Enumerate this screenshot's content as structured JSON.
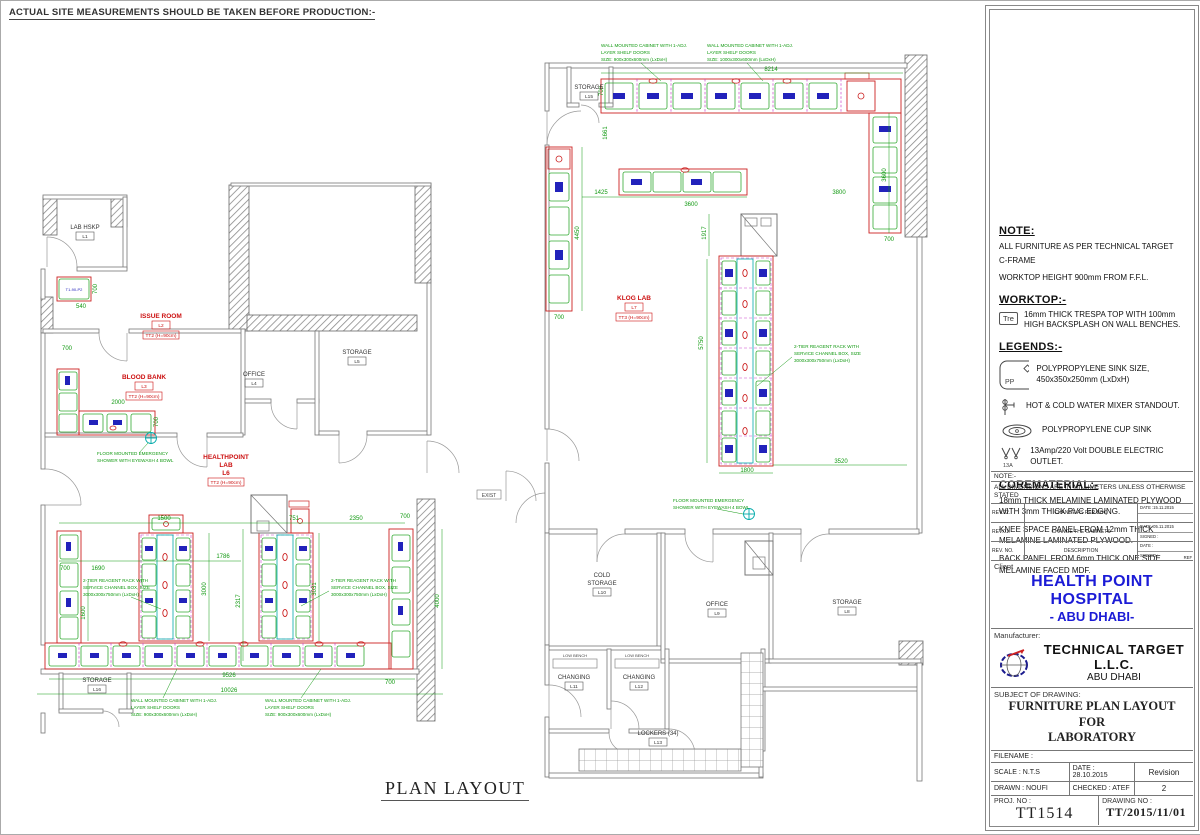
{
  "sheet": {
    "top_note": "ACTUAL SITE MEASUREMENTS SHOULD BE TAKEN BEFORE PRODUCTION:-",
    "plan_title": "PLAN LAYOUT",
    "exist_label": "EXIST"
  },
  "colors": {
    "client_blue": "#1b1bd6",
    "dim_green": "#119911",
    "cabinet_red": "#cc2222",
    "label_blue": "#2222bb",
    "channel_cyan": "#00aaaa"
  },
  "notes": {
    "reagent": [
      "2-TIER REAGENT RACK WITH",
      "SERVICE CHANNEL BOX, SIZE",
      "3000x300x750mm (LxDxH)"
    ],
    "wall_cab_900": [
      "WALL MOUNTED CABINET WITH 1-ADJ.",
      "LAYER SHELF DOORS",
      "SIZE: 900x300x600mm (LxDxH)"
    ],
    "wall_cab_1000": [
      "WALL MOUNTED CABINET WITH 1-ADJ.",
      "LAYER SHELF DOORS",
      "SIZE: 1000x300x600mm (LxDxH)"
    ],
    "shower": [
      "FLOOR MOUNTED EMERGENCY",
      "SHOWER WITH EYEWASH 4 BOWL"
    ],
    "low_bench": "LOW BENCH",
    "cabinet_code": "T1-90-P2"
  },
  "left_plan": {
    "rooms": [
      {
        "name": "LAB HSKP",
        "code": "L1"
      },
      {
        "name": "ISSUE ROOM",
        "code": "L2",
        "type": "TT2 (H=90cm)"
      },
      {
        "name": "BLOOD BANK",
        "code": "L3",
        "type": "TT2 (H=90cm)"
      },
      {
        "name": "OFFICE",
        "code": "L4"
      },
      {
        "name": "STORAGE",
        "code": "L5"
      },
      {
        "name": "HEALTHPOINT",
        "name2": "LAB",
        "code": "L6",
        "type": "TT2 (H=90cm)"
      },
      {
        "name": "STORAGE",
        "code": "L16"
      }
    ],
    "dims": [
      "540",
      "700",
      "700",
      "2000",
      "700",
      "1500",
      "751",
      "2350",
      "700",
      "1786",
      "1690",
      "700",
      "3000",
      "2317",
      "3031",
      "1600",
      "4000",
      "9526",
      "10026",
      "700"
    ]
  },
  "right_plan": {
    "rooms": [
      {
        "name": "STORAGE",
        "code": "L15"
      },
      {
        "name": "KLOG LAB",
        "code": "L7",
        "type": "TT3 (H=90cm)"
      },
      {
        "name": "COLD",
        "name2": "STORAGE",
        "code": "L10"
      },
      {
        "name": "OFFICE",
        "code": "L9"
      },
      {
        "name": "STORAGE",
        "code": "L8"
      },
      {
        "name": "CHANGING",
        "code": "L11"
      },
      {
        "name": "CHANGING",
        "code": "L12"
      },
      {
        "name": "LOCKERS (34)",
        "code": "L13"
      }
    ],
    "dims": [
      "8214",
      "700",
      "1661",
      "1425",
      "3600",
      "3800",
      "4450",
      "700",
      "1917",
      "5750",
      "3600",
      "700",
      "1800",
      "3520"
    ]
  },
  "panel": {
    "note": {
      "title": "NOTE:",
      "lines": [
        "ALL FURNITURE AS PER TECHNICAL TARGET",
        "C-FRAME",
        "WORKTOP HEIGHT 900mm FROM F.F.L."
      ]
    },
    "worktop": {
      "title": "WORKTOP:-",
      "icon_label": "Tre",
      "text": "16mm THICK TRESPA TOP WITH 100mm HIGH BACKSPLASH ON WALL BENCHES."
    },
    "legends": {
      "title": "LEGENDS:-",
      "sink_icon_label": "PP",
      "outlet_icon_label": "13A",
      "items": [
        "POLYPROPYLENE SINK SIZE, 450x350x250mm (LxDxH)",
        "HOT & COLD WATER MIXER STANDOUT.",
        "POLYPROPYLENE  CUP SINK",
        "13Amp/220 Volt DOUBLE ELECTRIC OUTLET."
      ]
    },
    "corematerial": {
      "title": "COREMATERIAL:-",
      "paras": [
        "18mm THICK MELAMINE LAMINATED PLYWOOD WITH 3mm THICK PVC EDGING.",
        "KNEE SPACE PANEL FROM 12mm THICK MELAMINE LAMINATED PLYWOOD.",
        "BACK PANEL FROM 6mm THICK ONE SIDE MELAMINE FACED MDF."
      ]
    },
    "note2": {
      "label": "NOTE:-",
      "text": "ALL DIMENSIONS ARE IN MILLIMETERS UNLESS OTHERWISE STATED"
    },
    "revisions": {
      "rows": [
        {
          "no": "REV.02.",
          "desc": "CHANGE AS PER BOQ",
          "date": "DATE :15.11.2015",
          "signed": ""
        },
        {
          "no": "REV.01.",
          "desc": "CHANGE THE CABINETS",
          "date": "DATE :05.11.2015",
          "signed": "SIGNED :"
        },
        {
          "no": "REV. NO.",
          "desc": "DESCRIPTION",
          "date": "DATE :",
          "signed": "SIGNED :"
        }
      ],
      "ref_label": "REF"
    },
    "client": {
      "label": "Client",
      "name": "HEALTH POINT HOSPITAL",
      "city": "- ABU DHABI-"
    },
    "manufacturer": {
      "label": "Manufacturer:",
      "name": "TECHNICAL TARGET L.L.C.",
      "city": "ABU DHABI"
    },
    "subject": {
      "label": "SUBJECT OF DRAWING:",
      "line1": "FURNITURE PLAN LAYOUT FOR",
      "line2": "LABORATORY"
    },
    "info": {
      "filename": "FILENAME :",
      "scale": "SCALE : N.T.S",
      "date": "DATE : 28.10.2015",
      "revision_label": "Revision",
      "drawn": "DRAWN : NOUFI",
      "checked": "CHECKED : ATEF",
      "revision_value": "2",
      "proj_label": "PROJ. NO :",
      "proj_value": "TT1514",
      "drawing_label": "DRAWING NO :",
      "drawing_value": "TT/2015/11/01"
    }
  }
}
